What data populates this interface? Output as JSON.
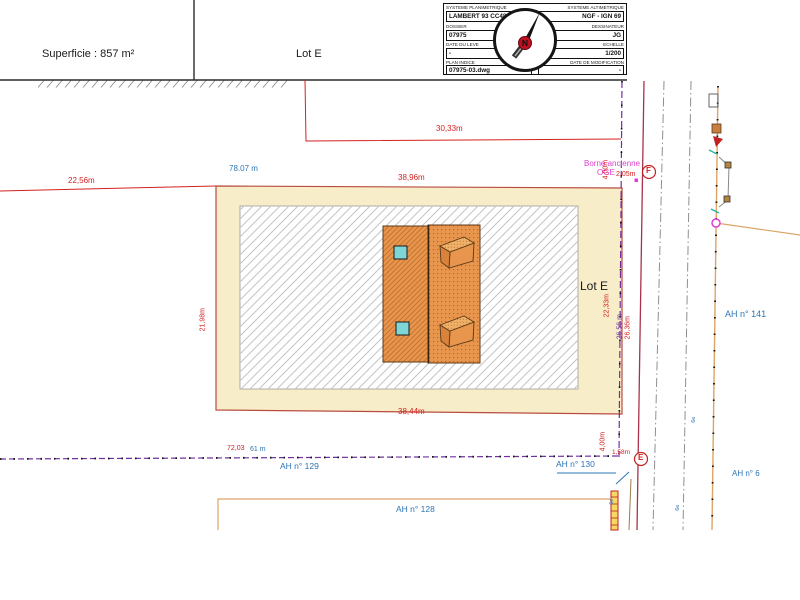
{
  "header": {
    "superficie": "Superficie : 857 m²",
    "lot": "Lot E"
  },
  "title_block": {
    "sys_plan": {
      "label": "SYSTEME PLANIMETRIQUE",
      "value": "LAMBERT 93 CC48"
    },
    "sys_alt": {
      "label": "SYSTEME ALTIMETRIQUE",
      "value": "NGF - IGN 69"
    },
    "dossier": {
      "label": "DOSSIER",
      "value": "07975"
    },
    "dessinateur": {
      "label": "DESSINATEUR",
      "value": "JG"
    },
    "date_leve": {
      "label": "DATE DU LEVE",
      "value": "-"
    },
    "echelle": {
      "label": "ECHELLE",
      "value": "1/200"
    },
    "plan_indice": {
      "label": "PLAN INDICE",
      "value": "07975-03.dwg"
    },
    "date_modif": {
      "label": "DATE DE MODIFICATION",
      "value": "-"
    },
    "compass_letter": "N"
  },
  "plan": {
    "lot_label": "Lot E",
    "borne": {
      "line1": "Borne ancienne",
      "line2": "OGE",
      "dim": "2,05m"
    },
    "points": {
      "f": "F",
      "e": "E"
    },
    "dims": {
      "d3033": "30,33m",
      "d7807": "78.07 m",
      "d2256": "22,56m",
      "d3896": "38,96m",
      "d2198": "21,98m",
      "d3844": "38,44m",
      "d400": "4,00m",
      "d2233": "22,33m",
      "d2656": "26,56 m",
      "d2636": "26,36m",
      "d158": "1,58m",
      "d7203": "72,03",
      "d61": "61 m"
    },
    "parcels": {
      "p141": "AH n° 141",
      "p129": "AH n° 129",
      "p130": "AH n° 130",
      "p128": "AH n° 128",
      "p6": "AH n° 6"
    },
    "marks": {
      "tiny": "6e"
    }
  },
  "colors": {
    "dim_red": "#d42020",
    "cadastral_blue": "#2e75b6",
    "borne_magenta": "#e03fd0",
    "boundary_purple": "#7030a0",
    "lot_fill": "#f8edc9",
    "building_orange": "#e8954d",
    "window_cyan": "#7fd6d6",
    "road_orange": "#dca567",
    "crimson_line": "#a8324a",
    "hatch_gray": "#c4c4c4"
  }
}
